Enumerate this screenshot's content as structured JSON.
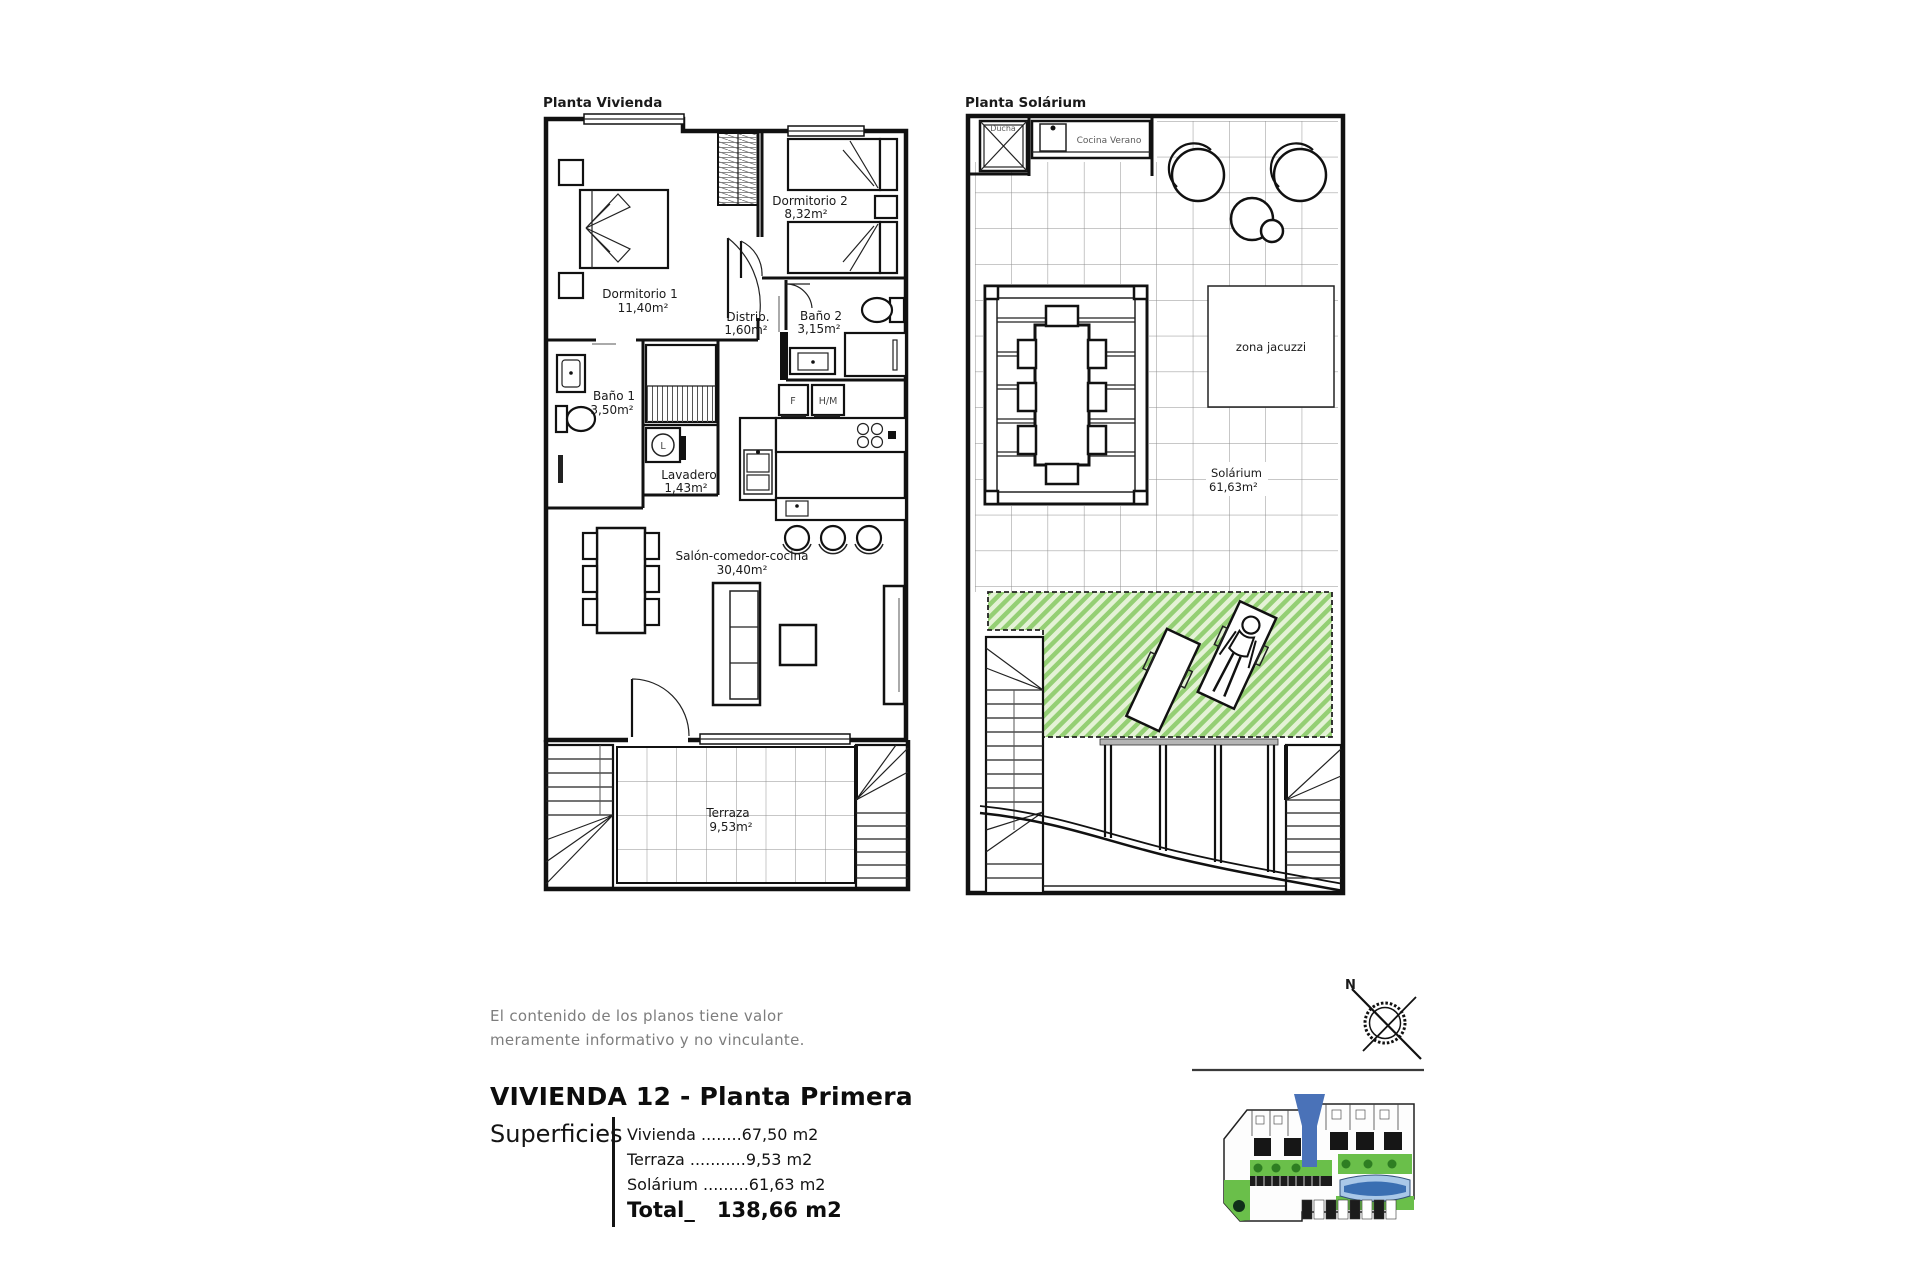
{
  "plans": {
    "vivienda": {
      "title": "Planta Vivienda",
      "rooms": [
        {
          "name": "Dormitorio 1",
          "area": "11,40m²"
        },
        {
          "name": "Dormitorio 2",
          "area": "8,32m²"
        },
        {
          "name": "Distrib.",
          "area": "1,60m²"
        },
        {
          "name": "Baño 2",
          "area": "3,15m²"
        },
        {
          "name": "Baño 1",
          "area": "3,50m²"
        },
        {
          "name": "Lavadero",
          "area": "1,43m²"
        },
        {
          "name": "Salón-comedor-cocina",
          "area": "30,40m²"
        },
        {
          "name": "Terraza",
          "area": "9,53m²"
        }
      ],
      "appliances": {
        "fridge": "F",
        "oven": "H/M",
        "washer": "L"
      }
    },
    "solarium": {
      "title": "Planta Solárium",
      "ducha": "Ducha",
      "cocina_verano": "Cocina Verano",
      "zona_jacuzzi": "zona jacuzzi",
      "room_name": "Solárium",
      "room_area": "61,63m²"
    }
  },
  "disclaimer": {
    "line1": "El contenido de los planos tiene valor",
    "line2": "meramente informativo y no vinculante."
  },
  "title_block": {
    "title": "VIVIENDA 12 - Planta Primera",
    "superficies_label": "Superficies",
    "rows": [
      "Vivienda ........67,50 m2",
      "Terraza ...........9,53 m2",
      "Solárium .........61,63 m2"
    ],
    "total_label": "Total_",
    "total_value": "138,66 m2"
  },
  "compass": {
    "north_label": "N"
  },
  "colors": {
    "green_hatch": "#94cf74",
    "marker_blue": "#4a72b8",
    "site_green": "#6abf4a",
    "pool_blue": "#3a6fb2"
  }
}
